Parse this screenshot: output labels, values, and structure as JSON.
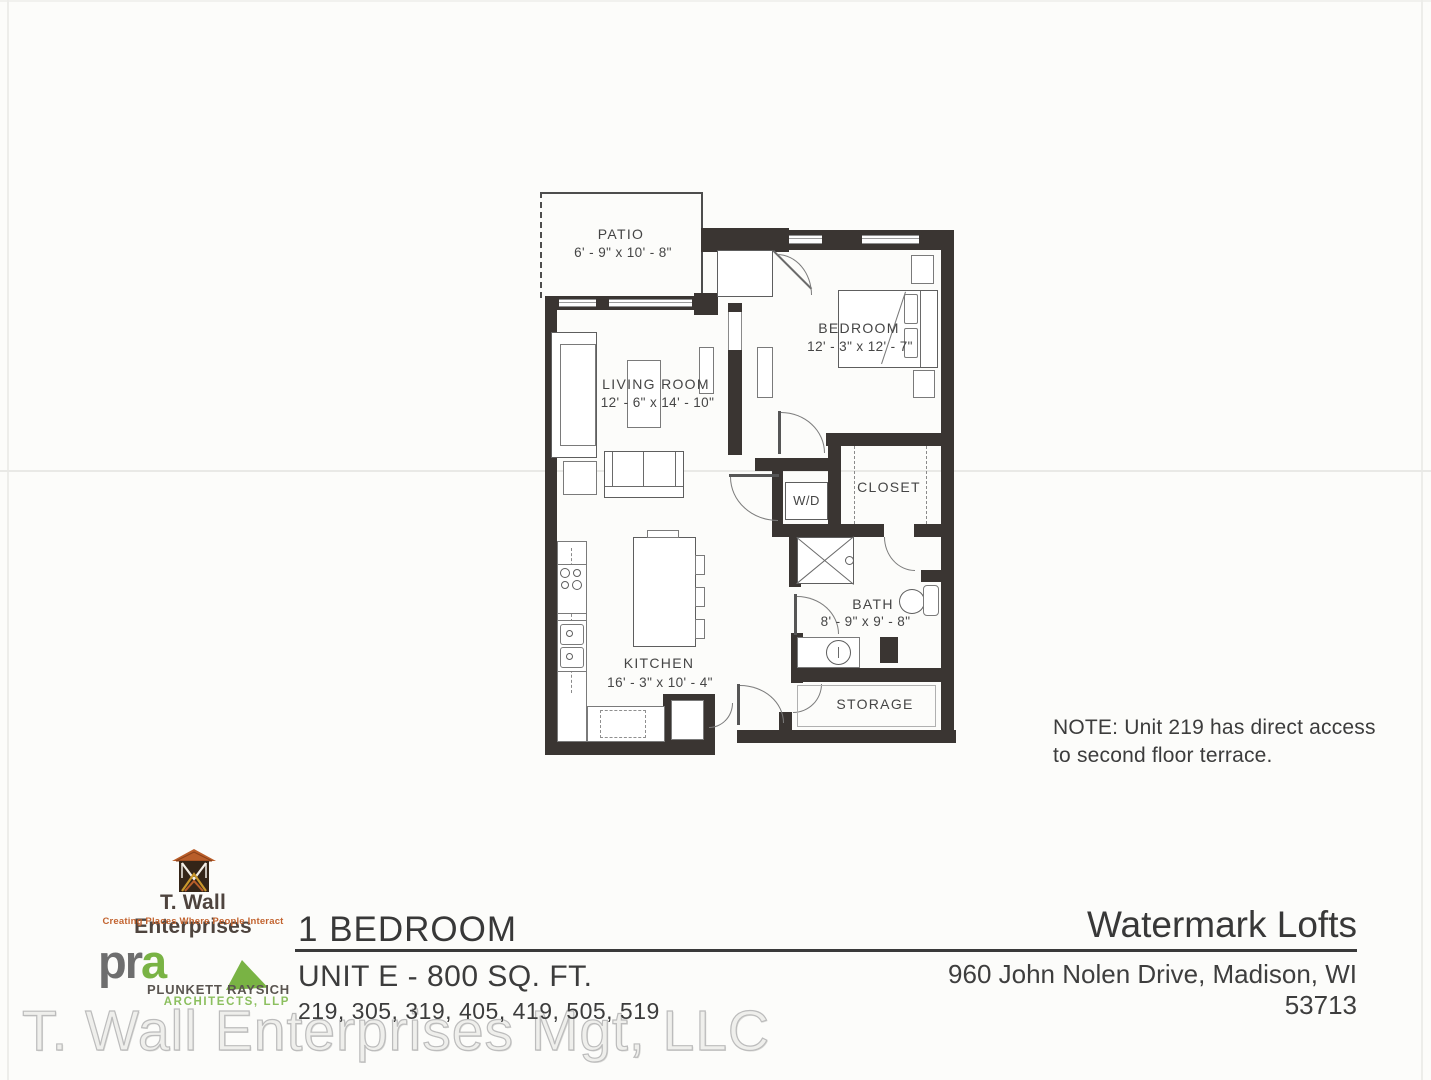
{
  "plan": {
    "rooms": {
      "patio": {
        "name": "PATIO",
        "dims": "6' - 9\" x 10' - 8\""
      },
      "living_room": {
        "name": "LIVING ROOM",
        "dims": "12' - 6\" x 14' - 10\""
      },
      "bedroom": {
        "name": "BEDROOM",
        "dims": "12' - 3\" x 12' - 7\""
      },
      "closet": {
        "name": "CLOSET"
      },
      "laundry": {
        "name": "W/D"
      },
      "bath": {
        "name": "BATH",
        "dims": "8' - 9\" x 9' - 8\""
      },
      "kitchen": {
        "name": "KITCHEN",
        "dims": "16' - 3\" x 10' - 4\""
      },
      "storage": {
        "name": "STORAGE"
      }
    },
    "note": {
      "line1": "NOTE: Unit 219 has direct access",
      "line2": "to second floor terrace."
    }
  },
  "footer": {
    "developer_logo": {
      "name": "T. Wall Enterprises",
      "tagline": "Creating Places Where People Interact"
    },
    "architect_logo": {
      "wordmark_pr": "pr",
      "wordmark_a": "a",
      "firm_line1": "PLUNKETT RAYSICH",
      "firm_line2": "ARCHITECTS, LLP"
    },
    "plan_type": "1 BEDROOM",
    "unit_info": "UNIT E - 800 SQ. FT.",
    "unit_numbers": "219, 305, 319, 405, 419, 505, 519",
    "property_name": "Watermark Lofts",
    "property_address": "960 John Nolen Drive, Madison, WI 53713",
    "watermark": "T. Wall Enterprises Mgt, LLC"
  },
  "colors": {
    "wall": "#3a3532",
    "accent_orange": "#c2632f",
    "accent_green": "#79b344",
    "label": "#454545"
  }
}
